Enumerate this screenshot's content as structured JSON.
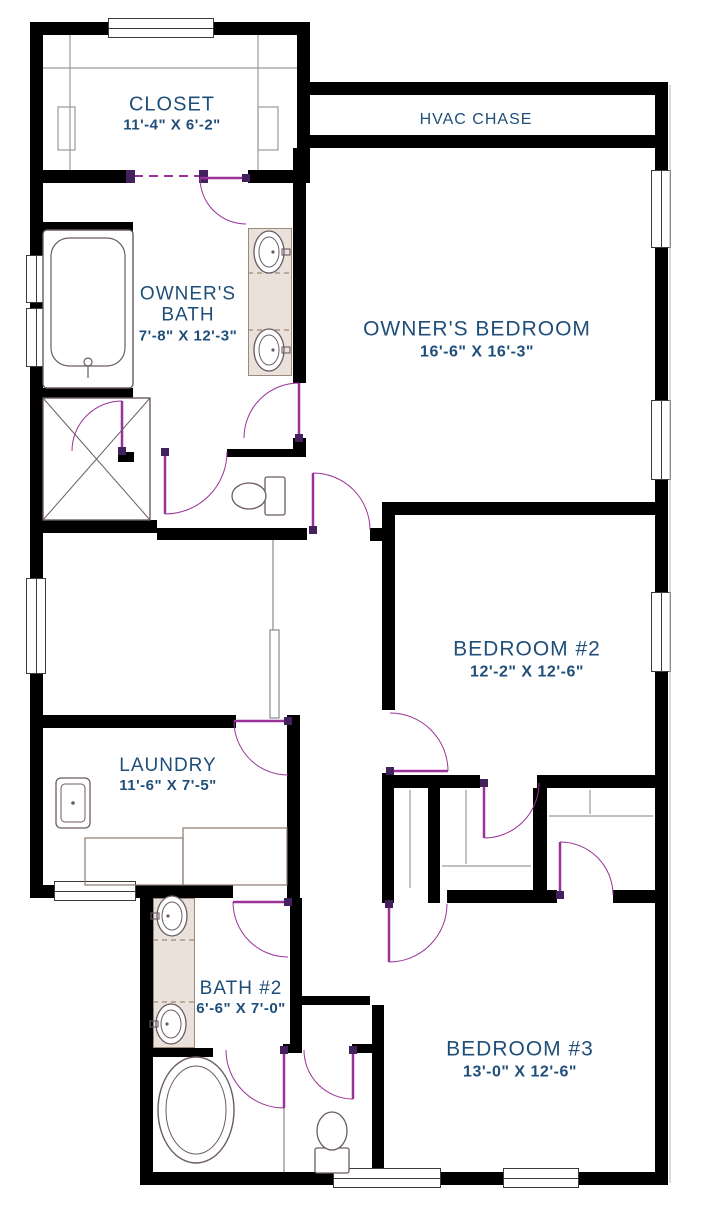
{
  "canvas": {
    "w": 702,
    "h": 1209
  },
  "colors": {
    "wall": "#000000",
    "label": "#1F4E79",
    "door": "#993399",
    "door_jamb": "#42215C",
    "fixture": "#6B5B66",
    "shelf": "#9A9A9A",
    "rail": "#8A8A8A",
    "faint": "#C0C0C0",
    "counter": "#8A7A6E",
    "vanity": "#9B8A7A",
    "vanity_fill": "#EAE2DA",
    "window_edge": "#3A3A3A"
  },
  "rooms": [
    {
      "name": "CLOSET",
      "dims": "11'-4\" X 6'-2\""
    },
    {
      "name": "HVAC CHASE",
      "dims": ""
    },
    {
      "name": "OWNER'S BATH",
      "dims": "7'-8\" X 12'-3\""
    },
    {
      "name": "OWNER'S BEDROOM",
      "dims": "16'-6\" X 16'-3\""
    },
    {
      "name": "BEDROOM #2",
      "dims": "12'-2\" X 12'-6\""
    },
    {
      "name": "LAUNDRY",
      "dims": "11'-6\" X 7'-5\""
    },
    {
      "name": "BATH #2",
      "dims": "6'-6\" X 7'-0\""
    },
    {
      "name": "BEDROOM #3",
      "dims": "13'-0\" X 12'-6\""
    }
  ],
  "walls": [
    {
      "x": 30,
      "y": 22,
      "w": 280,
      "h": 13
    },
    {
      "x": 30,
      "y": 22,
      "w": 13,
      "h": 876
    },
    {
      "x": 297,
      "y": 22,
      "w": 13,
      "h": 161
    },
    {
      "x": 297,
      "y": 82,
      "w": 371,
      "h": 13
    },
    {
      "x": 310,
      "y": 135,
      "w": 345,
      "h": 13
    },
    {
      "x": 655,
      "y": 82,
      "w": 13,
      "h": 1103
    },
    {
      "x": 140,
      "y": 1172,
      "w": 528,
      "h": 13
    },
    {
      "x": 140,
      "y": 898,
      "w": 13,
      "h": 274
    },
    {
      "x": 30,
      "y": 885,
      "w": 123,
      "h": 13
    },
    {
      "x": 153,
      "y": 885,
      "w": 80,
      "h": 13
    },
    {
      "x": 30,
      "y": 170,
      "w": 100,
      "h": 13
    },
    {
      "x": 248,
      "y": 170,
      "w": 62,
      "h": 13
    },
    {
      "x": 293,
      "y": 148,
      "w": 13,
      "h": 235
    },
    {
      "x": 293,
      "y": 438,
      "w": 13,
      "h": 19
    },
    {
      "x": 227,
      "y": 449,
      "w": 73,
      "h": 8
    },
    {
      "x": 157,
      "y": 528,
      "w": 150,
      "h": 12
    },
    {
      "x": 370,
      "y": 528,
      "w": 12,
      "h": 13
    },
    {
      "x": 30,
      "y": 222,
      "w": 103,
      "h": 10
    },
    {
      "x": 30,
      "y": 388,
      "w": 103,
      "h": 10
    },
    {
      "x": 30,
      "y": 520,
      "w": 127,
      "h": 13
    },
    {
      "x": 118,
      "y": 452,
      "w": 16,
      "h": 10
    },
    {
      "x": 30,
      "y": 715,
      "w": 206,
      "h": 13
    },
    {
      "x": 287,
      "y": 715,
      "w": 13,
      "h": 183
    },
    {
      "x": 290,
      "y": 898,
      "w": 12,
      "h": 150
    },
    {
      "x": 302,
      "y": 996,
      "w": 68,
      "h": 9
    },
    {
      "x": 372,
      "y": 1005,
      "w": 12,
      "h": 167
    },
    {
      "x": 153,
      "y": 1048,
      "w": 60,
      "h": 9
    },
    {
      "x": 283,
      "y": 1044,
      "w": 19,
      "h": 9
    },
    {
      "x": 352,
      "y": 1044,
      "w": 20,
      "h": 9
    },
    {
      "x": 382,
      "y": 502,
      "w": 13,
      "h": 208
    },
    {
      "x": 382,
      "y": 773,
      "w": 12,
      "h": 130
    },
    {
      "x": 382,
      "y": 502,
      "w": 273,
      "h": 13
    },
    {
      "x": 392,
      "y": 775,
      "w": 88,
      "h": 13
    },
    {
      "x": 537,
      "y": 775,
      "w": 118,
      "h": 13
    },
    {
      "x": 428,
      "y": 788,
      "w": 12,
      "h": 115
    },
    {
      "x": 533,
      "y": 788,
      "w": 14,
      "h": 115
    },
    {
      "x": 447,
      "y": 890,
      "w": 110,
      "h": 13
    },
    {
      "x": 613,
      "y": 890,
      "w": 42,
      "h": 13
    }
  ],
  "windows": [
    {
      "x": 108,
      "y": 18,
      "w": 106,
      "h": 20,
      "o": "h"
    },
    {
      "x": 26,
      "y": 255,
      "w": 20,
      "h": 48,
      "o": "v"
    },
    {
      "x": 26,
      "y": 308,
      "w": 20,
      "h": 59,
      "o": "v"
    },
    {
      "x": 26,
      "y": 578,
      "w": 20,
      "h": 96,
      "o": "v"
    },
    {
      "x": 651,
      "y": 170,
      "w": 20,
      "h": 78,
      "o": "v"
    },
    {
      "x": 651,
      "y": 400,
      "w": 20,
      "h": 80,
      "o": "v"
    },
    {
      "x": 651,
      "y": 592,
      "w": 20,
      "h": 80,
      "o": "v"
    },
    {
      "x": 54,
      "y": 881,
      "w": 82,
      "h": 20,
      "o": "h"
    },
    {
      "x": 333,
      "y": 1168,
      "w": 108,
      "h": 20,
      "o": "h"
    },
    {
      "x": 503,
      "y": 1168,
      "w": 76,
      "h": 20,
      "o": "h"
    }
  ],
  "doors": [
    {
      "name": "closet-to-bath-door",
      "hinge": [
        246,
        178
      ],
      "r": 46,
      "leaf": 180,
      "from": 180,
      "to": 90
    },
    {
      "name": "owners-bath-door",
      "hinge": [
        299,
        438
      ],
      "r": 55,
      "leaf": 270,
      "from": 270,
      "to": 180
    },
    {
      "name": "water-closet-door",
      "hinge": [
        165,
        452
      ],
      "r": 62,
      "leaf": 90,
      "from": 0,
      "to": 90
    },
    {
      "name": "owners-bedroom-door",
      "hinge": [
        313,
        530
      ],
      "r": 57,
      "leaf": 270,
      "from": 270,
      "to": 0
    },
    {
      "name": "bedroom2-door",
      "hinge": [
        390,
        771
      ],
      "r": 58,
      "leaf": 0,
      "from": 270,
      "to": 0
    },
    {
      "name": "bedroom2-closet-door",
      "hinge": [
        484,
        783
      ],
      "r": 55,
      "leaf": 90,
      "from": 90,
      "to": 0
    },
    {
      "name": "bedroom3-closet-door",
      "hinge": [
        560,
        895
      ],
      "r": 53,
      "leaf": 270,
      "from": 270,
      "to": 0
    },
    {
      "name": "bedroom3-door",
      "hinge": [
        389,
        904
      ],
      "r": 58,
      "leaf": 90,
      "from": 90,
      "to": 0
    },
    {
      "name": "laundry-door",
      "hinge": [
        288,
        721
      ],
      "r": 54,
      "leaf": 180,
      "from": 180,
      "to": 90
    },
    {
      "name": "bath2-door",
      "hinge": [
        288,
        902
      ],
      "r": 55,
      "leaf": 180,
      "from": 180,
      "to": 90
    },
    {
      "name": "wetroom-door",
      "hinge": [
        284,
        1050
      ],
      "r": 58,
      "leaf": 90,
      "from": 90,
      "to": 180
    },
    {
      "name": "toilet-compartment-door",
      "hinge": [
        353,
        1050
      ],
      "r": 49,
      "leaf": 90,
      "from": 90,
      "to": 180
    },
    {
      "name": "shower-door",
      "hinge": [
        122,
        451
      ],
      "r": 50,
      "leaf": 270,
      "from": 270,
      "to": 180
    }
  ],
  "openings": [
    {
      "name": "closet-cased-opening",
      "x1": 134,
      "y1": 176,
      "x2": 201,
      "y2": 176,
      "jambs": [
        [
          126,
          170
        ],
        [
          199,
          170
        ]
      ]
    }
  ],
  "fills": [
    {
      "name": "owners-bath-vanity-counter",
      "x": 248,
      "y": 228,
      "w": 44,
      "h": 148
    },
    {
      "name": "bath2-vanity-counter",
      "x": 153,
      "y": 898,
      "w": 42,
      "h": 150
    }
  ],
  "fixtures": [
    {
      "type": "bathtub",
      "x": 43,
      "y": 230,
      "w": 90,
      "h": 158
    },
    {
      "type": "shower",
      "x": 43,
      "y": 398,
      "w": 107,
      "h": 122
    },
    {
      "type": "sink",
      "cx": 269,
      "cy": 252,
      "rx": 15,
      "ry": 21,
      "side": "right"
    },
    {
      "type": "sink",
      "cx": 269,
      "cy": 350,
      "rx": 15,
      "ry": 21,
      "side": "right"
    },
    {
      "type": "toilet",
      "cx": 249,
      "cy": 496,
      "dir": "left"
    },
    {
      "type": "sink",
      "cx": 172,
      "cy": 916,
      "rx": 15,
      "ry": 20,
      "side": "left"
    },
    {
      "type": "sink",
      "cx": 171,
      "cy": 1024,
      "rx": 15,
      "ry": 20,
      "side": "left"
    },
    {
      "type": "oval-tub",
      "cx": 196,
      "cy": 1110,
      "rx": 38,
      "ry": 53
    },
    {
      "type": "toilet",
      "cx": 332,
      "cy": 1131,
      "dir": "up"
    },
    {
      "type": "utility-sink",
      "x": 56,
      "y": 778,
      "w": 34,
      "h": 50
    }
  ],
  "lines": [
    {
      "x1": 70,
      "y1": 35,
      "x2": 70,
      "y2": 170,
      "c": "shelf"
    },
    {
      "x1": 258,
      "y1": 35,
      "x2": 258,
      "y2": 170,
      "c": "shelf"
    },
    {
      "x1": 43,
      "y1": 68,
      "x2": 297,
      "y2": 68,
      "c": "shelf"
    },
    {
      "x1": 410,
      "y1": 790,
      "x2": 410,
      "y2": 888,
      "c": "shelf"
    },
    {
      "x1": 466,
      "y1": 790,
      "x2": 466,
      "y2": 864,
      "c": "shelf"
    },
    {
      "x1": 442,
      "y1": 866,
      "x2": 531,
      "y2": 866,
      "c": "shelf"
    },
    {
      "x1": 549,
      "y1": 816,
      "x2": 653,
      "y2": 816,
      "c": "shelf"
    },
    {
      "x1": 590,
      "y1": 790,
      "x2": 590,
      "y2": 814,
      "c": "shelf"
    },
    {
      "x1": 273,
      "y1": 540,
      "x2": 273,
      "y2": 630,
      "c": "rail"
    },
    {
      "x1": 670,
      "y1": 85,
      "x2": 670,
      "y2": 1183,
      "c": "faint"
    },
    {
      "x1": 284,
      "y1": 1106,
      "x2": 284,
      "y2": 1172,
      "c": "rail"
    },
    {
      "x1": 248,
      "y1": 273,
      "x2": 292,
      "y2": 273,
      "c": "vanity",
      "d": 1
    },
    {
      "x1": 248,
      "y1": 330,
      "x2": 292,
      "y2": 330,
      "c": "vanity",
      "d": 1
    },
    {
      "x1": 153,
      "y1": 940,
      "x2": 195,
      "y2": 940,
      "c": "vanity",
      "d": 1
    },
    {
      "x1": 153,
      "y1": 1002,
      "x2": 195,
      "y2": 1002,
      "c": "vanity",
      "d": 1
    }
  ],
  "outlines": [
    {
      "x": 85,
      "y": 838,
      "w": 98,
      "h": 47,
      "c": "counter"
    },
    {
      "x": 183,
      "y": 828,
      "w": 104,
      "h": 57,
      "c": "counter"
    },
    {
      "x": 270,
      "y": 630,
      "w": 9,
      "h": 88,
      "c": "rail"
    },
    {
      "x": 58,
      "y": 107,
      "w": 17,
      "h": 43,
      "c": "shelf"
    },
    {
      "x": 258,
      "y": 107,
      "w": 20,
      "h": 43,
      "c": "shelf"
    }
  ]
}
